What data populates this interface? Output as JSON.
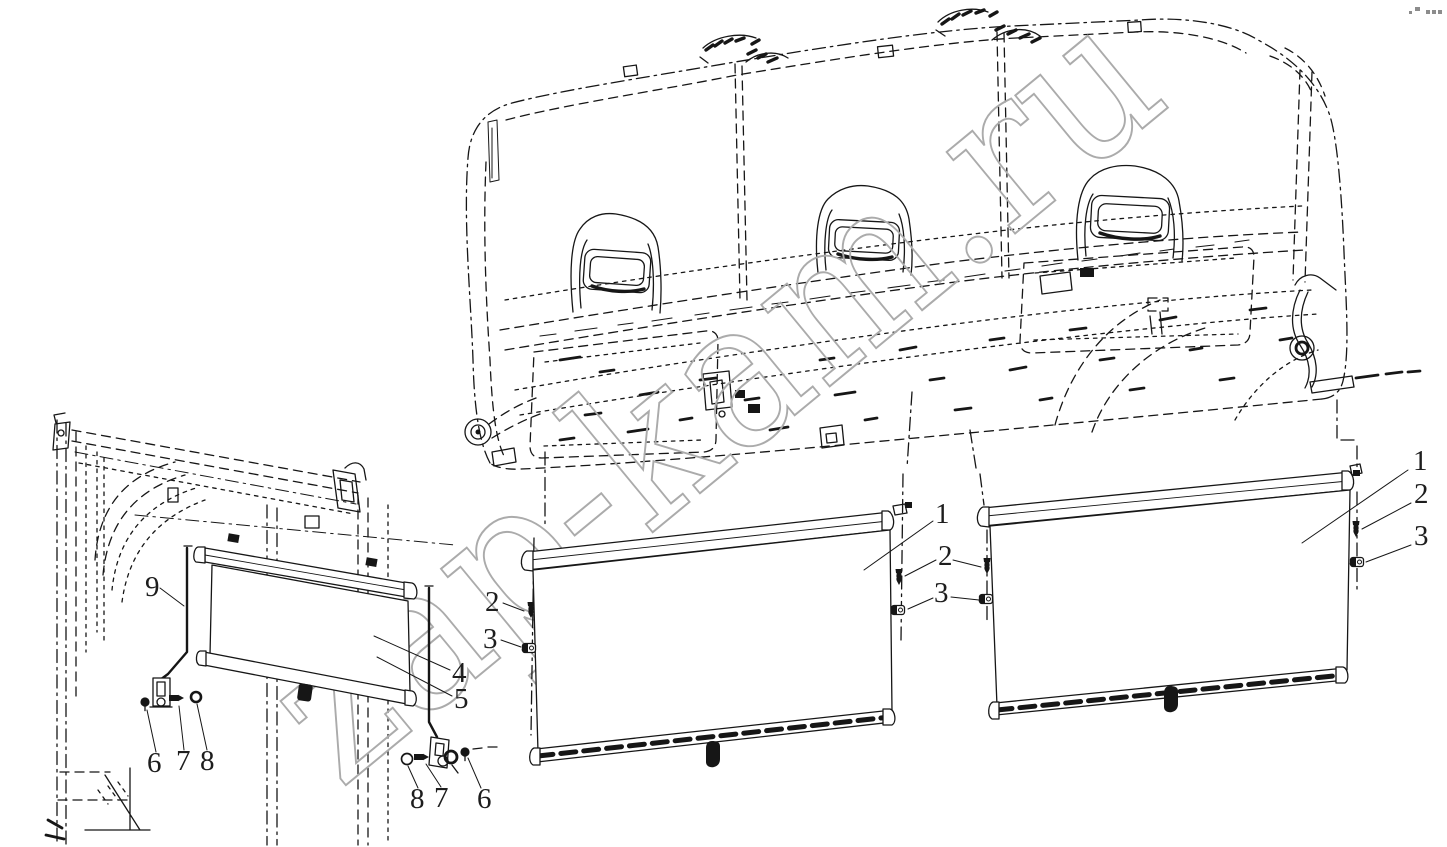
{
  "canvas": {
    "width": 1447,
    "height": 847,
    "background": "#ffffff",
    "ink": "#161616"
  },
  "watermark": {
    "text": "zap-kam.ru",
    "color": "#ababab"
  },
  "corner_marks": {
    "color": "#8c8c8c",
    "pattern": "small squares: 2 + 3"
  },
  "callouts": {
    "center_blind": {
      "c1": "1",
      "c2_left": "2",
      "c3_left": "3",
      "c2_right": "2",
      "c3_right": "3"
    },
    "right_blind": {
      "c1": "1",
      "c2": "2",
      "c3": "3"
    },
    "side_view": {
      "c9": "9",
      "c4": "4",
      "c5": "5",
      "c6_left": "6",
      "c7_left": "7",
      "c8_left": "8",
      "c8_right": "8",
      "c7_right": "7",
      "c6_right": "6"
    }
  }
}
